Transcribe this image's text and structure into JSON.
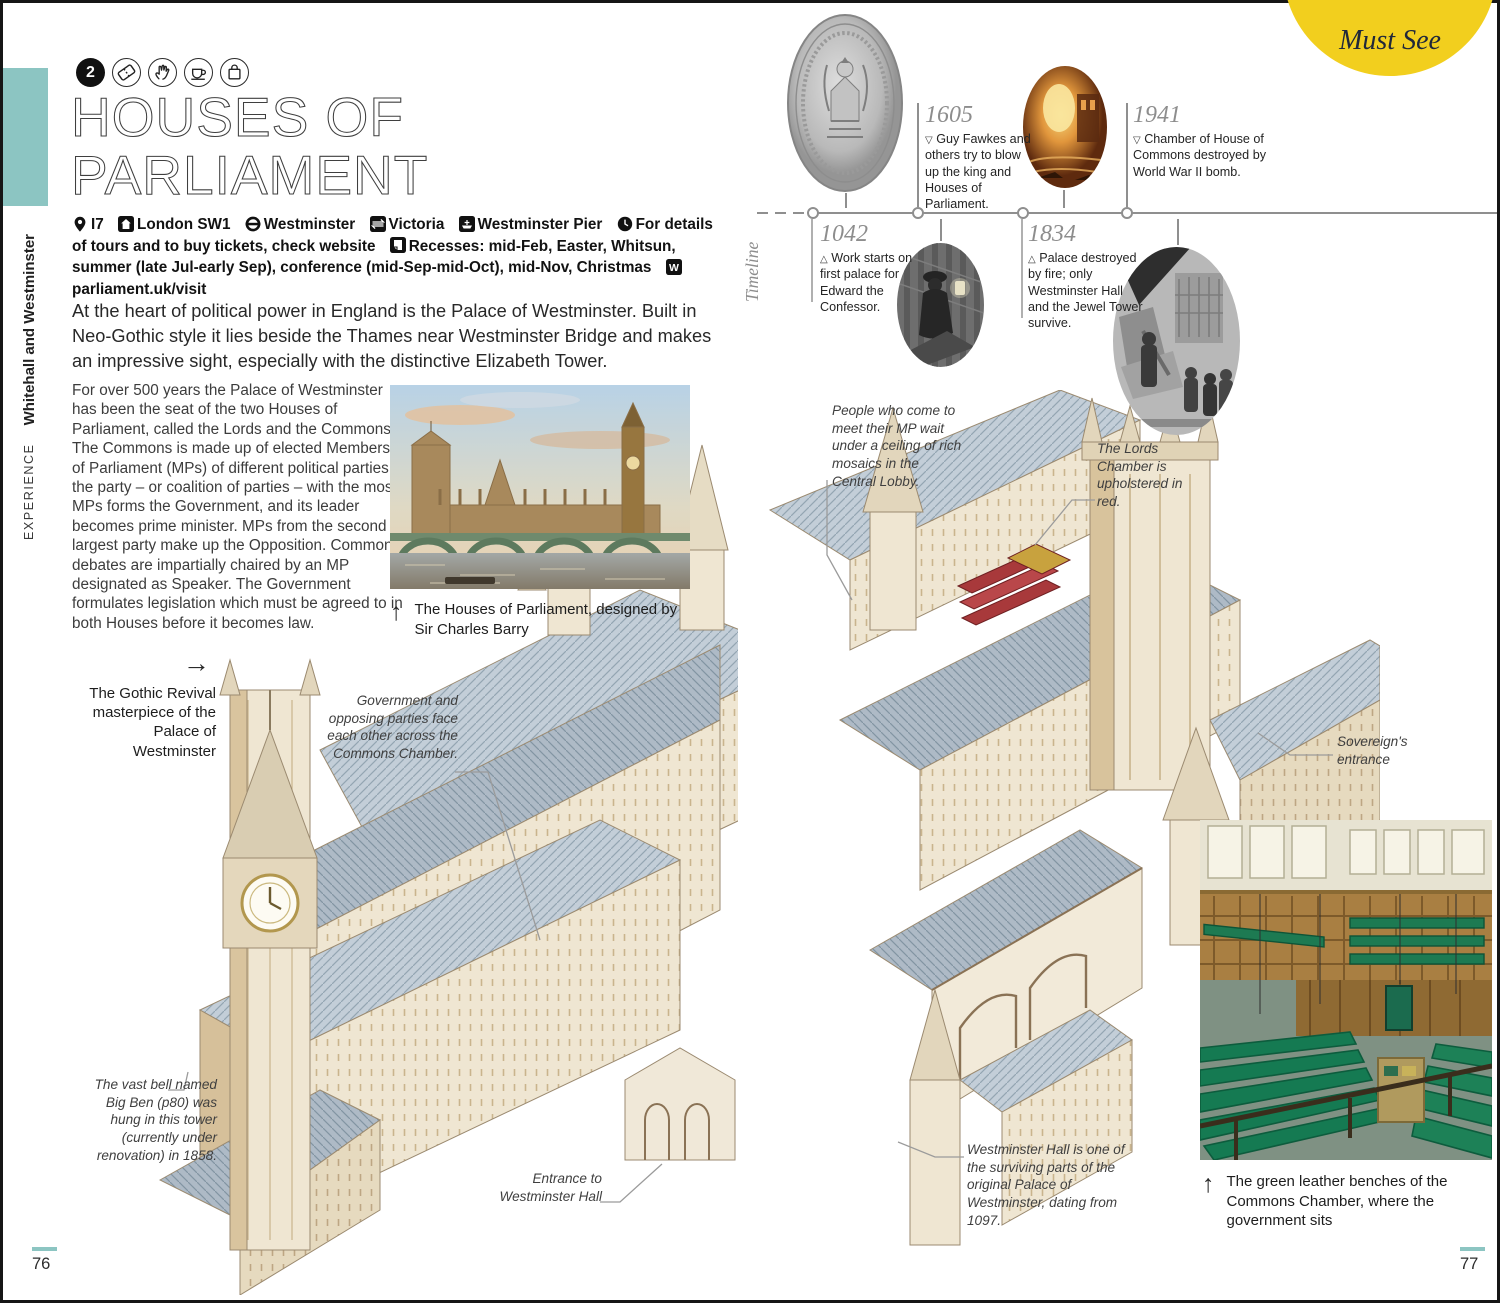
{
  "sidebar": {
    "section": "EXPERIENCE",
    "chapter": "Whitehall and Westminster"
  },
  "header": {
    "number": "2",
    "icons": [
      "ticket-icon",
      "hand-icon",
      "cup-icon",
      "bag-icon"
    ],
    "title1": "HOUSES OF",
    "title2": "PARLIAMENT"
  },
  "info": {
    "segments": [
      {
        "icon": "location-pin-icon",
        "text": "I7"
      },
      {
        "icon": "house-icon",
        "text": "London SW1"
      },
      {
        "icon": "underground-icon",
        "text": "Westminster"
      },
      {
        "icon": "rail-icon",
        "text": "Victoria"
      },
      {
        "icon": "boat-icon",
        "text": "Westminster Pier"
      },
      {
        "icon": "clock-icon",
        "text": "For details of tours and to buy tickets, check website"
      },
      {
        "icon": "recess-icon",
        "text": "Recesses: mid-Feb, Easter, Whitsun, summer (late Jul-early Sep), conference (mid-Sep-mid-Oct), mid-Nov, Christmas"
      },
      {
        "icon": "website-icon",
        "text": "parliament.uk/visit"
      }
    ]
  },
  "intro": {
    "text": "At the heart of political power in England is the Palace of Westminster. Built in Neo-Gothic style it lies beside the Thames near Westminster Bridge and makes an impressive sight, especially with the distinctive Elizabeth Tower."
  },
  "body": {
    "text": "For over 500 years the Palace of Westminster has been the seat of the two Houses of Parliament, called the Lords and the Commons. The Commons is made up of elected Members of Parliament (MPs) of different political parties; the party – or coalition of parties – with the most MPs forms the Government, and its leader becomes prime minister. MPs from the second largest party make up the Opposition. Commons debates are impartially chaired by an MP designated as Speaker. The Government formulates legislation which must be agreed to in both Houses before it becomes law."
  },
  "photo": {
    "caption": "The Houses of Parliament, designed by Sir Charles Barry"
  },
  "badge": {
    "label": "Must See"
  },
  "timeline": {
    "label": "Timeline",
    "entries": [
      {
        "year": "1042",
        "marker": "△",
        "text": "Work starts on first palace for Edward the Confessor."
      },
      {
        "year": "1605",
        "marker": "▽",
        "text": "Guy Fawkes and others try to blow up the king and Houses of Parliament."
      },
      {
        "year": "1834",
        "marker": "△",
        "text": "Palace destroyed by fire; only Westminster Hall and the Jewel Tower survive."
      },
      {
        "year": "1941",
        "marker": "▽",
        "text": "Chamber of House of Commons destroyed by World War II bomb."
      }
    ]
  },
  "glyphs": {
    "up": "↑",
    "right": "→"
  },
  "ann": {
    "gothic": "The Gothic Revival masterpiece of the Palace of Westminster",
    "commons": "Government and opposing parties face each other across the Commons Chamber.",
    "lobby": "People who come to meet their MP wait under a ceiling of rich mosaics in the Central Lobby.",
    "lords": "The Lords Chamber is upholstered in red.",
    "sovereign": "Sovereign's entrance",
    "bigben": "The vast bell named Big Ben (p80) was hung in this tower (currently under renovation) in 1858.",
    "hall_entrance": "Entrance to Westminster Hall",
    "hall": "Westminster Hall is one of the surviving parts of the original Palace of Westminster, dating from 1097.",
    "benches": "The green leather benches of the Commons Chamber, where the government sits"
  },
  "pages": {
    "left": "76",
    "right": "77"
  },
  "colors": {
    "teal": "#8cc5c2",
    "yellow": "#f2cf1e",
    "bench_green": "#157a52",
    "lords_red": "#a8393b",
    "ink": "#3c3c3c"
  }
}
